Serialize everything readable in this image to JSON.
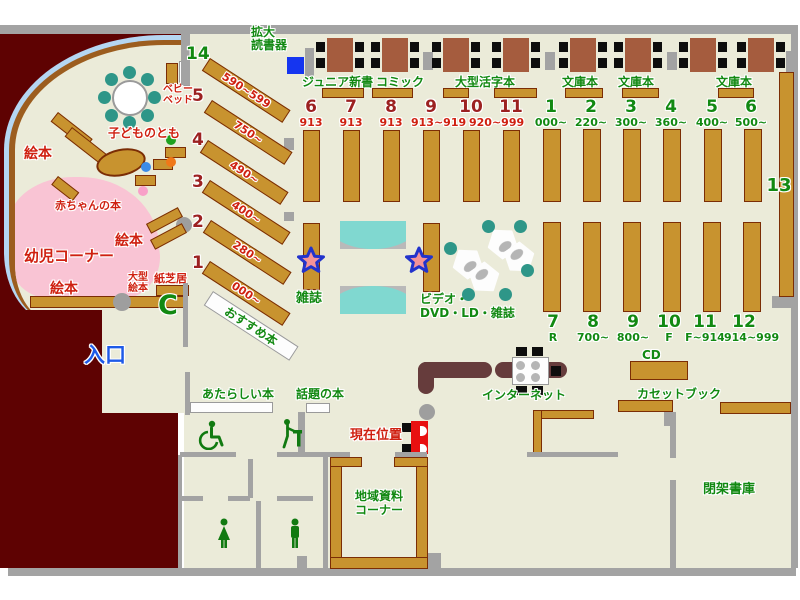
{
  "labels": {
    "entrance": "入口",
    "current_location": "現在位置",
    "magnifier_line1": "拡大",
    "magnifier_line2": "読書器",
    "junior_shinsho": "ジュニア新書",
    "comic": "コミック",
    "large_print": "大型活字本",
    "bunko": [
      "文庫本",
      "文庫本",
      "文庫本"
    ],
    "magazines": "雑誌",
    "av_line1": "ビデオ・",
    "av_line2": "DVD・LD・雑誌",
    "internet": "インターネット",
    "cd": "CD",
    "cassette_book": "カセットブック",
    "closed_stacks": "閉架書庫",
    "local_line1": "地域資料",
    "local_line2": "コーナー",
    "new_books": "あたらしい本",
    "topic_books": "話題の本",
    "recommended": "おすすめ本",
    "shelf13": "13",
    "phone": "C"
  },
  "kids": {
    "corner": "幼児コーナー",
    "baby_books": "赤ちゃんの本",
    "ehon_top": "絵本",
    "ehon_mid": "絵本",
    "ehon_bottom": "絵本",
    "kodomo_no_tomo": "子どものとも",
    "baby_bed_line1": "ベビー",
    "baby_bed_line2": "ベッド",
    "large_ehon_line1": "大型",
    "large_ehon_line2": "絵本",
    "kamishibai": "紙芝居"
  },
  "diagonal_shelves": [
    {
      "no": "14",
      "range": "590~599"
    },
    {
      "no": "5",
      "range": "750~"
    },
    {
      "no": "4",
      "range": "490~"
    },
    {
      "no": "3",
      "range": "400~"
    },
    {
      "no": "2",
      "range": "280~"
    },
    {
      "no": "1",
      "range": "000~"
    }
  ],
  "stacks_red": [
    {
      "no": "6",
      "range": "913"
    },
    {
      "no": "7",
      "range": "913"
    },
    {
      "no": "8",
      "range": "913"
    },
    {
      "no": "9",
      "range": "913~919"
    },
    {
      "no": "10",
      "range": "920~999"
    },
    {
      "no": "11",
      "range": ""
    }
  ],
  "stacks_green_top": [
    {
      "no": "1",
      "range": "000~"
    },
    {
      "no": "2",
      "range": "220~"
    },
    {
      "no": "3",
      "range": "300~"
    },
    {
      "no": "4",
      "range": "360~"
    },
    {
      "no": "5",
      "range": "400~"
    },
    {
      "no": "6",
      "range": "500~"
    }
  ],
  "stacks_green_bottom": [
    {
      "no": "7",
      "range": "R"
    },
    {
      "no": "8",
      "range": "700~"
    },
    {
      "no": "9",
      "range": "800~"
    },
    {
      "no": "10",
      "range": "F"
    },
    {
      "no": "11",
      "range": "F~914"
    },
    {
      "no": "12",
      "range": "914~999"
    }
  ],
  "colors": {
    "floor": "#ebebd9",
    "wall_gray": "#a3a3a3",
    "maroon": "#5e0202",
    "shelf_brown": "#c8932f",
    "shelf_border": "#7b2d05",
    "table_brown": "#a55c3e",
    "teal": "#2e9688",
    "bench_teal": "#80d8d0",
    "pink_area": "#f9c4d4",
    "arc_blue": "#b5d6f2",
    "arc_brown": "#9c5d1f",
    "green_text": "#128912",
    "red_text": "#cf2010",
    "dark_red_number": "#9c2121",
    "entrance_blue": "#1e5ae8",
    "device_blue": "#1535f0",
    "star_fill": "#f49398",
    "star_border": "#2233cc",
    "counter_brown": "#663c3c"
  }
}
